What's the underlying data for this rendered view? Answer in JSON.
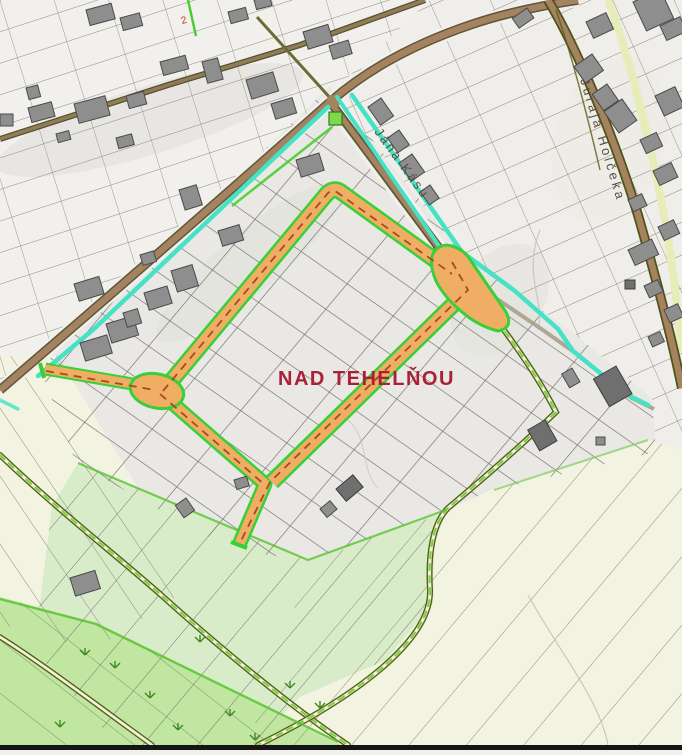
{
  "map": {
    "area_label": "NAD TEHELŇOU",
    "streets": {
      "north_south": "Jána Kásu",
      "east": "Juraja Holčeka"
    },
    "marker": "2",
    "colors": {
      "development_road": "#efae63",
      "road_edge_green": "#38cf38",
      "boundary_cyan": "#45e2c6",
      "centerline_red": "#a84a20",
      "label_red": "#a92038",
      "existing_road": "#a58260",
      "road_casing": "#5f5738",
      "field_green": "#d9ecca",
      "field_bright_green": "#c0e6a2",
      "field_cream": "#f3f3e1",
      "track_olive": "#556016",
      "building_gray": "#8e8e8e"
    }
  }
}
